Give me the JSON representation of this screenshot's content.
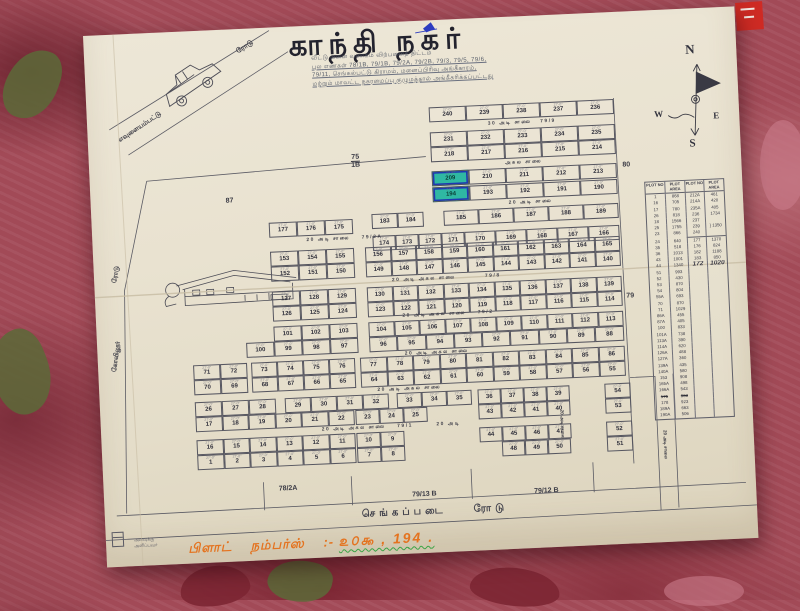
{
  "title": "காந்தி நகர்",
  "subtitle_lines": [
    "வீட்டு மனை வளாகம் விற்பனைத் திட்டம்",
    "புல எண்கள் 78/1B, 79/1B, 79/2A, 79/2B, 79/3, 79/5, 79/6,",
    "79/11, செங்கல்பட்டு கிராமம், மனைப்பிரிவு அங்கீகாரம்,",
    "மற்றும் மாவட்ட நகரமைப்பு குழுமத்தால் அங்கீகரிக்கப்பட்டது"
  ],
  "compass": {
    "n": "N",
    "e": "E",
    "w": "W",
    "s": "S"
  },
  "map": {
    "dim": "27'-0\"",
    "highlights": [
      "209",
      "194"
    ],
    "rows": [
      {
        "x": 342,
        "y": 87,
        "w": 37,
        "cells": [
          "240",
          "239",
          "238",
          "237",
          "236"
        ]
      },
      {
        "x": 342,
        "y": 112,
        "w": 37,
        "cells": [
          "231",
          "232",
          "233",
          "234",
          "235"
        ]
      },
      {
        "x": 342,
        "y": 127,
        "w": 37,
        "cells": [
          "218",
          "217",
          "216",
          "215",
          "214"
        ]
      },
      {
        "x": 342,
        "y": 151,
        "w": 37,
        "cells": [
          "209",
          "210",
          "211",
          "212",
          "213"
        ]
      },
      {
        "x": 342,
        "y": 167,
        "w": 37,
        "cells": [
          "194",
          "193",
          "192",
          "191",
          "190"
        ]
      },
      {
        "x": 280,
        "y": 191,
        "w": 26,
        "cells": [
          "183",
          "184"
        ]
      },
      {
        "x": 352,
        "y": 191,
        "w": 35,
        "cells": [
          "185",
          "186",
          "187",
          "188",
          "189"
        ]
      },
      {
        "x": 280,
        "y": 213,
        "w": 23,
        "cells": [
          "174",
          "173",
          "172",
          "171"
        ]
      },
      {
        "x": 372,
        "y": 213,
        "w": 31,
        "cells": [
          "170",
          "169",
          "168",
          "167",
          "166"
        ]
      },
      {
        "x": 177,
        "y": 195,
        "w": 28,
        "cells": [
          "177",
          "176",
          "175"
        ]
      },
      {
        "x": 177,
        "y": 224,
        "w": 28,
        "cells": [
          "153",
          "154",
          "155"
        ]
      },
      {
        "x": 272,
        "y": 224,
        "w": 25.5,
        "cells": [
          "156",
          "157",
          "158",
          "159",
          "160",
          "161",
          "162",
          "163",
          "164",
          "165"
        ]
      },
      {
        "x": 177,
        "y": 239,
        "w": 28,
        "cells": [
          "152",
          "151",
          "150"
        ]
      },
      {
        "x": 272,
        "y": 239,
        "w": 25.5,
        "cells": [
          "149",
          "148",
          "147",
          "146",
          "145",
          "144",
          "143",
          "142",
          "141",
          "140"
        ]
      },
      {
        "x": 177,
        "y": 264,
        "w": 28,
        "cells": [
          "127",
          "128",
          "129"
        ]
      },
      {
        "x": 272,
        "y": 264,
        "w": 25.5,
        "cells": [
          "130",
          "131",
          "132",
          "133",
          "134",
          "135",
          "136",
          "137",
          "138",
          "139"
        ]
      },
      {
        "x": 177,
        "y": 279,
        "w": 28,
        "cells": [
          "126",
          "125",
          "124"
        ]
      },
      {
        "x": 272,
        "y": 279,
        "w": 25.5,
        "cells": [
          "123",
          "122",
          "121",
          "120",
          "119",
          "118",
          "117",
          "116",
          "115",
          "114"
        ]
      },
      {
        "x": 177,
        "y": 299,
        "w": 28,
        "cells": [
          "101",
          "102",
          "103"
        ]
      },
      {
        "x": 272,
        "y": 299,
        "w": 25.5,
        "cells": [
          "104",
          "105",
          "106",
          "107",
          "108",
          "109",
          "110",
          "111",
          "112",
          "113"
        ]
      },
      {
        "x": 149,
        "y": 314,
        "w": 28,
        "cells": [
          "100",
          "99",
          "98",
          "97"
        ]
      },
      {
        "x": 272,
        "y": 314,
        "w": 28.3,
        "cells": [
          "96",
          "95",
          "94",
          "93",
          "92",
          "91",
          "90",
          "89",
          "88"
        ]
      },
      {
        "x": 95,
        "y": 334,
        "w": 27,
        "cells": [
          "71",
          "72"
        ]
      },
      {
        "x": 153,
        "y": 334,
        "w": 26,
        "cells": [
          "73",
          "74",
          "75",
          "76"
        ]
      },
      {
        "x": 262,
        "y": 334,
        "w": 26.5,
        "cells": [
          "77",
          "78",
          "79",
          "80",
          "81",
          "82",
          "83",
          "84",
          "85",
          "86"
        ]
      },
      {
        "x": 95,
        "y": 349,
        "w": 27,
        "cells": [
          "70",
          "69"
        ]
      },
      {
        "x": 153,
        "y": 349,
        "w": 26,
        "cells": [
          "68",
          "67",
          "66",
          "65"
        ]
      },
      {
        "x": 262,
        "y": 349,
        "w": 26.5,
        "cells": [
          "64",
          "63",
          "62",
          "61",
          "60",
          "59",
          "58",
          "57",
          "56",
          "55"
        ]
      },
      {
        "x": 95,
        "y": 371,
        "w": 27,
        "cells": [
          "26",
          "27",
          "28"
        ]
      },
      {
        "x": 185,
        "y": 371,
        "w": 26,
        "cells": [
          "29",
          "30",
          "31",
          "32"
        ]
      },
      {
        "x": 297,
        "y": 371,
        "w": 25,
        "cells": [
          "33",
          "34",
          "35"
        ]
      },
      {
        "x": 378,
        "y": 371,
        "w": 23,
        "cells": [
          "36",
          "37",
          "38",
          "39"
        ]
      },
      {
        "x": 505,
        "y": 371,
        "w": 26,
        "cells": [
          "54"
        ]
      },
      {
        "x": 95,
        "y": 386,
        "w": 26.5,
        "cells": [
          "17",
          "18",
          "19",
          "20",
          "21",
          "22"
        ]
      },
      {
        "x": 255,
        "y": 386,
        "w": 24,
        "cells": [
          "23",
          "24",
          "25"
        ]
      },
      {
        "x": 378,
        "y": 386,
        "w": 23,
        "cells": [
          "43",
          "42",
          "41",
          "40"
        ]
      },
      {
        "x": 505,
        "y": 386,
        "w": 26,
        "cells": [
          "53"
        ]
      },
      {
        "x": 95,
        "y": 409,
        "w": 26.5,
        "cells": [
          "16",
          "15",
          "14",
          "13",
          "12",
          "11"
        ]
      },
      {
        "x": 255,
        "y": 409,
        "w": 24,
        "cells": [
          "10",
          "9"
        ]
      },
      {
        "x": 378,
        "y": 409,
        "w": 23,
        "cells": [
          "44",
          "45",
          "46",
          "47"
        ]
      },
      {
        "x": 505,
        "y": 409,
        "w": 26,
        "cells": [
          "52"
        ]
      },
      {
        "x": 95,
        "y": 424,
        "w": 26.5,
        "cells": [
          "1",
          "2",
          "3",
          "4",
          "5",
          "6"
        ]
      },
      {
        "x": 255,
        "y": 424,
        "w": 24,
        "cells": [
          "7",
          "8"
        ]
      },
      {
        "x": 400,
        "y": 424,
        "w": 23,
        "cells": [
          "48",
          "49",
          "50"
        ]
      },
      {
        "x": 505,
        "y": 424,
        "w": 26,
        "cells": [
          "51"
        ]
      }
    ],
    "roads": [
      {
        "t": "30 அடி சாலை   79/9",
        "x": 342,
        "y": 103,
        "w": 185
      },
      {
        "t": "அகல சாலை",
        "x": 342,
        "y": 143,
        "w": 185
      },
      {
        "t": "20 அடி சாலை",
        "x": 352,
        "y": 183,
        "w": 175
      },
      {
        "t": "20 அடி சாலை    79/2A",
        "x": 177,
        "y": 211,
        "w": 150
      },
      {
        "t": "20 அடி அகல சாலை          79/8",
        "x": 177,
        "y": 255,
        "w": 350
      },
      {
        "t": "20 அடி அகல சாலை    79/2",
        "x": 177,
        "y": 291,
        "w": 350
      },
      {
        "t": "20 அடி அகல சாலை",
        "x": 149,
        "y": 329,
        "w": 380
      },
      {
        "t": "20 அடி அகல சாலை",
        "x": 95,
        "y": 364,
        "w": 430
      },
      {
        "t": "20 அடி அகல சாலை    79/1        20 அடி",
        "x": 95,
        "y": 401,
        "w": 390
      },
      {
        "t": "செங்கப்படை    ரோடு",
        "x": 200,
        "y": 485,
        "w": 260,
        "fs": 10,
        "ls": 4
      }
    ],
    "labels": [
      {
        "t": "75",
        "t2": "1B",
        "x": 262,
        "y": 130
      },
      {
        "t": "87",
        "x": 135,
        "y": 168
      },
      {
        "t": "80",
        "x": 533,
        "y": 150
      },
      {
        "t": "79",
        "x": 531,
        "y": 281
      },
      {
        "t": "78/2A",
        "x": 175,
        "y": 458
      },
      {
        "t": "79/13 B",
        "x": 308,
        "y": 470
      },
      {
        "t": "79/12 B",
        "x": 430,
        "y": 472
      },
      {
        "t": "20 அடி சாலை",
        "x": 458,
        "y": 395,
        "vert": true,
        "fs": 4.5
      },
      {
        "t": "20 அடி சாலை",
        "x": 560,
        "y": 420,
        "vert": true,
        "fs": 4.5
      },
      {
        "t": "ரோடு",
        "x": 14,
        "y": 236,
        "rot": -78,
        "fs": 6.5
      },
      {
        "t": "கோவிலூர்",
        "x": 4,
        "y": 318,
        "rot": -80,
        "fs": 6.5
      },
      {
        "t": "ரோடு",
        "x": 152,
        "y": 14,
        "rot": -31,
        "fs": 7
      },
      {
        "t": "எவுளையம்பட்டு",
        "x": 28,
        "y": 90,
        "rot": -31,
        "fs": 6.5
      }
    ]
  },
  "table": {
    "headers": [
      "PLOT NO",
      "PLOT AREA",
      "PLOT NO",
      "PLOT AREA"
    ],
    "sep_after": 6,
    "left": [
      [
        "1",
        "868"
      ],
      [
        "16",
        "705"
      ],
      [
        "17",
        "780"
      ],
      [
        "26",
        "818"
      ],
      [
        "18",
        "1566"
      ],
      [
        "25",
        "1755"
      ],
      [
        "23",
        "866"
      ],
      [
        "24",
        "640"
      ],
      [
        "35",
        "518"
      ],
      [
        "36",
        "1013"
      ],
      [
        "43",
        "1001"
      ],
      [
        "44",
        "1340"
      ],
      [
        "51",
        "993"
      ],
      [
        "52",
        "430"
      ],
      [
        "53",
        "870"
      ],
      [
        "54",
        "804"
      ],
      [
        "55A",
        "693"
      ],
      [
        "70",
        "870"
      ],
      [
        "71",
        "1029"
      ],
      [
        "86A",
        "455"
      ],
      [
        "87A",
        "405"
      ],
      [
        "100",
        "833"
      ],
      [
        "101A",
        "738"
      ],
      [
        "113A",
        "390"
      ],
      [
        "114A",
        "620"
      ],
      [
        "126A",
        "488"
      ],
      [
        "127A",
        "360"
      ],
      [
        "139A",
        "435"
      ],
      [
        "140A",
        "580"
      ],
      [
        "153",
        "908"
      ],
      [
        "165A",
        "498"
      ],
      [
        "166A",
        "543"
      ],
      [
        "175",
        "963",
        "s"
      ],
      [
        "178",
        "923"
      ],
      [
        "189A",
        "663"
      ],
      [
        "190A",
        "506"
      ]
    ],
    "right": [
      [
        "212A",
        "461"
      ],
      [
        "214A",
        "420"
      ],
      [
        "235A",
        "405"
      ],
      [
        "236",
        "1734"
      ],
      [
        "237",
        ""
      ],
      [
        "239",
        "} 1350"
      ],
      [
        "240",
        ""
      ],
      [
        "177",
        "1370"
      ],
      [
        "176",
        "824"
      ],
      [
        "182",
        "1188"
      ],
      [
        "183",
        "850"
      ],
      [
        "172",
        "1020",
        "b"
      ]
    ]
  },
  "footer": {
    "printed": [
      "அளவுக்கு",
      "அளிப்பவர்"
    ],
    "hand_prefix": "பிளாட் நம்பர்ஸ் :-",
    "hand_numbers": "௨௦௯ , 194 ."
  }
}
